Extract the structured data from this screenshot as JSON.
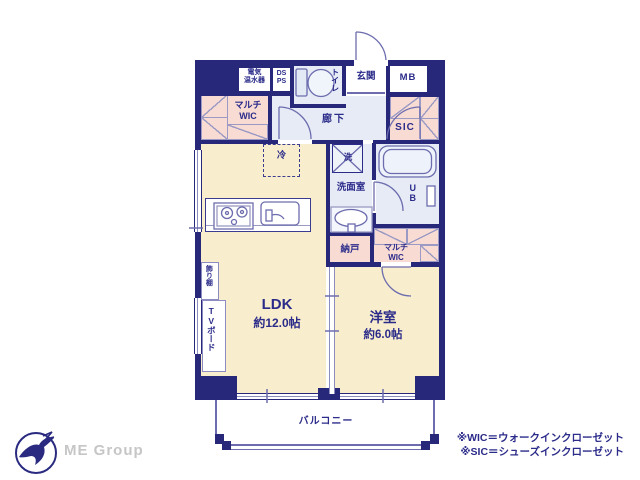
{
  "colors": {
    "wall_navy": "#28287a",
    "floor_cream": "#f8eecd",
    "closet_pink": "#f8dcd4",
    "wet_area_blue": "#e6ebf6",
    "text_navy": "#2b2b8a",
    "fixture_line": "#6c6cae",
    "brand_gray": "#c6c6c6"
  },
  "rooms": {
    "ldk": {
      "name": "LDK",
      "area": "約12.0帖"
    },
    "western_room": {
      "name": "洋室",
      "area": "約6.0帖"
    },
    "balcony": "バルコニー",
    "hallway": "廊下",
    "entrance": "玄関",
    "toilet": "トイレ",
    "washroom": "洗面室",
    "unit_bath": "UB",
    "storage_room": "納戸"
  },
  "closets": {
    "multi_wic_upper": [
      "マルチ",
      "WIC"
    ],
    "multi_wic_lower": [
      "マルチ",
      "WIC"
    ],
    "shoes_closet": "SIC"
  },
  "equipment": {
    "water_heater": [
      "電気",
      "温水器"
    ],
    "duct_pipe_space": [
      "DS",
      "PS"
    ],
    "meter_box": "MB",
    "refrigerator": "冷",
    "washing_machine": "洗",
    "display_shelf": "飾り棚",
    "tv_board": "TVボード"
  },
  "footer": {
    "brand": "ME Group",
    "notes": [
      "※WIC＝ウォークインクローゼット",
      "※SIC＝シューズインクローゼット"
    ]
  }
}
